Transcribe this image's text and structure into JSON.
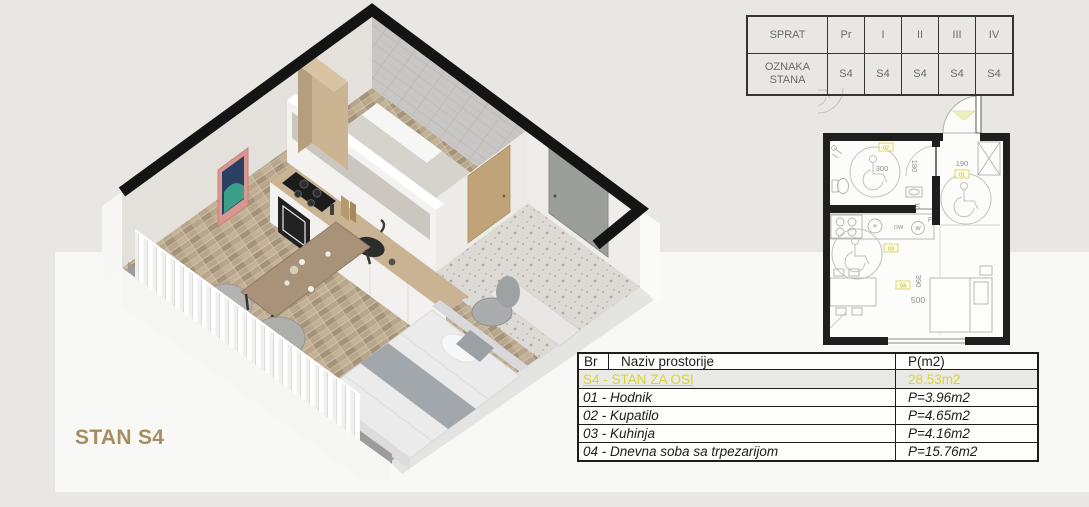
{
  "render_label": "STAN S4",
  "floor_table": {
    "header_label": "SPRAT",
    "row2_label": "OZNAKA STANA",
    "floors": [
      "Pr",
      "I",
      "II",
      "III",
      "IV"
    ],
    "units": [
      "S4",
      "S4",
      "S4",
      "S4",
      "S4"
    ]
  },
  "area_table": {
    "col_br": "Br",
    "col_name": "Naziv prostorije",
    "col_area": "P(m2)",
    "highlight": {
      "name": "S4 - STAN ZA OSI",
      "area": "28.53m2"
    },
    "rows": [
      {
        "name": "01 - Hodnik",
        "area": "P=3.96m2"
      },
      {
        "name": "02 - Kupatilo",
        "area": "P=4.65m2"
      },
      {
        "name": "03 - Kuhinja",
        "area": "P=4.16m2"
      },
      {
        "name": "04 - Dnevna soba sa trpezarijom",
        "area": "P=15.76m2"
      }
    ]
  },
  "floorplan": {
    "dims": {
      "bath_width": "300",
      "bath_height": "180",
      "hall_width": "190",
      "wall_thickness": "10",
      "living_height": "390",
      "living_width": "500"
    },
    "room_ids": {
      "hall": "01",
      "bath": "02",
      "kitchen": "03",
      "living": "04"
    },
    "appliances": {
      "washer": "W",
      "dishwasher": "DW",
      "fridge": "F"
    }
  },
  "colors": {
    "background": "#e9e7e4",
    "panel": "#f8f8f6",
    "highlight_yellow": "#d8d23e",
    "label_tan": "#a68e62",
    "wall_black": "#1a1a1a",
    "wood_floor": "#b7a68c",
    "terrazzo": "#dddad5"
  }
}
